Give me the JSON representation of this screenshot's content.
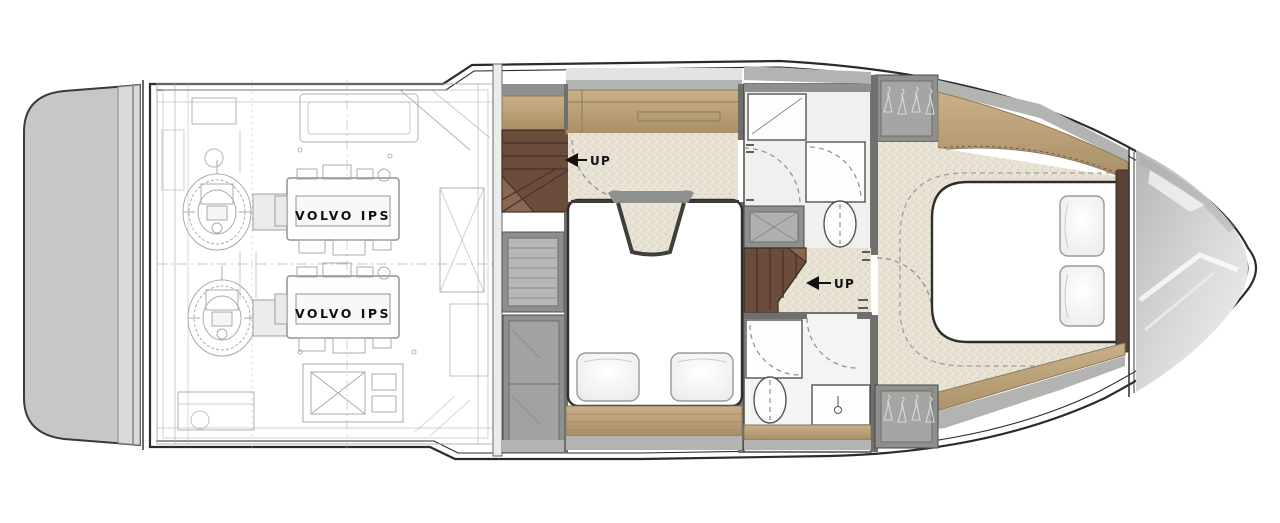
{
  "diagram": {
    "type": "yacht-lower-deck-floor-plan",
    "engine_labels": [
      "VOLVO IPS",
      "VOLVO IPS"
    ],
    "stair_labels": [
      "UP",
      "UP"
    ],
    "colors": {
      "hull-line": "#2b2b2b",
      "linework": "#a7acb0",
      "carpet": "#e9e3d5",
      "carpet-dot": "#cfc7b2",
      "wood-dark": "#8a7a5c",
      "stair-wood": "#6b4d3c",
      "stair-step": "#4e362a",
      "stair-light": "#8a6750",
      "headboard": "#5a4334",
      "wall-dark": "#6f6f6d",
      "wall-mid": "#8f8f8d",
      "wall-light": "#b3b3b1",
      "platform": "#c7c7c5",
      "text": "#111111"
    }
  }
}
